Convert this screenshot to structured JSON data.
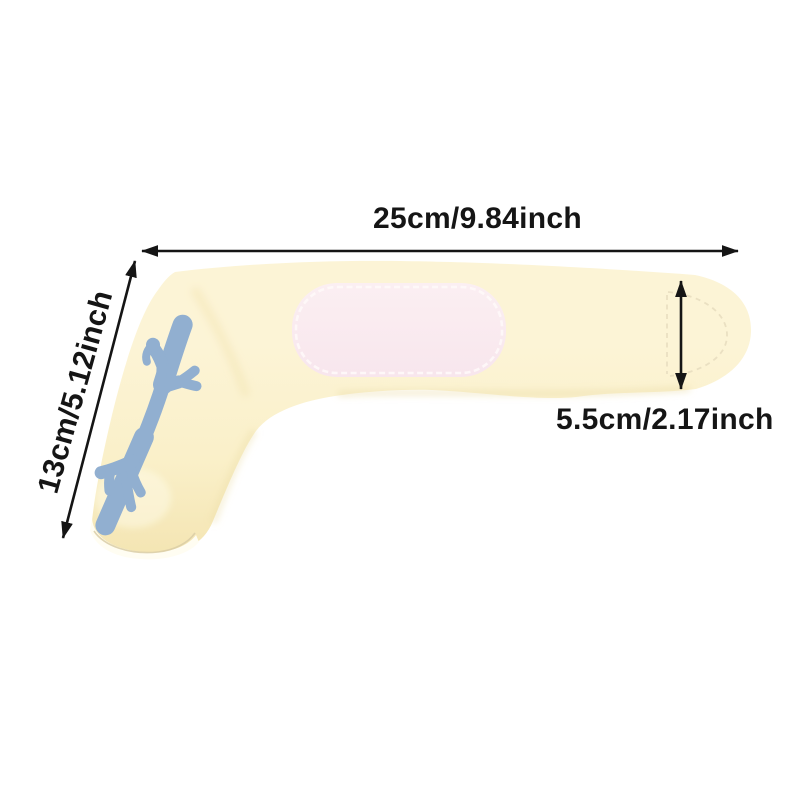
{
  "canvas": {
    "width": 800,
    "height": 800
  },
  "annotations": {
    "width_label": "25cm/9.84inch",
    "length_label": "13cm/5.12inch",
    "depth_label": "5.5cm/2.17inch"
  },
  "colors": {
    "background": "#ffffff",
    "band-light": "#FCF4D6",
    "band": "#FAF0C9",
    "band-shade": "#F4E5B3",
    "band-shadow": "#EBDBA2",
    "print": "#91AFD0",
    "patch": "#F8E6ED",
    "patch-light": "#FBEFF2",
    "patch-stitch": "#FEF8F8",
    "opening-rim": "#FFFDF2",
    "opening-crease": "#D9CDA6",
    "stitch-seam": "#EAE0C2",
    "annotation": "#151515"
  }
}
